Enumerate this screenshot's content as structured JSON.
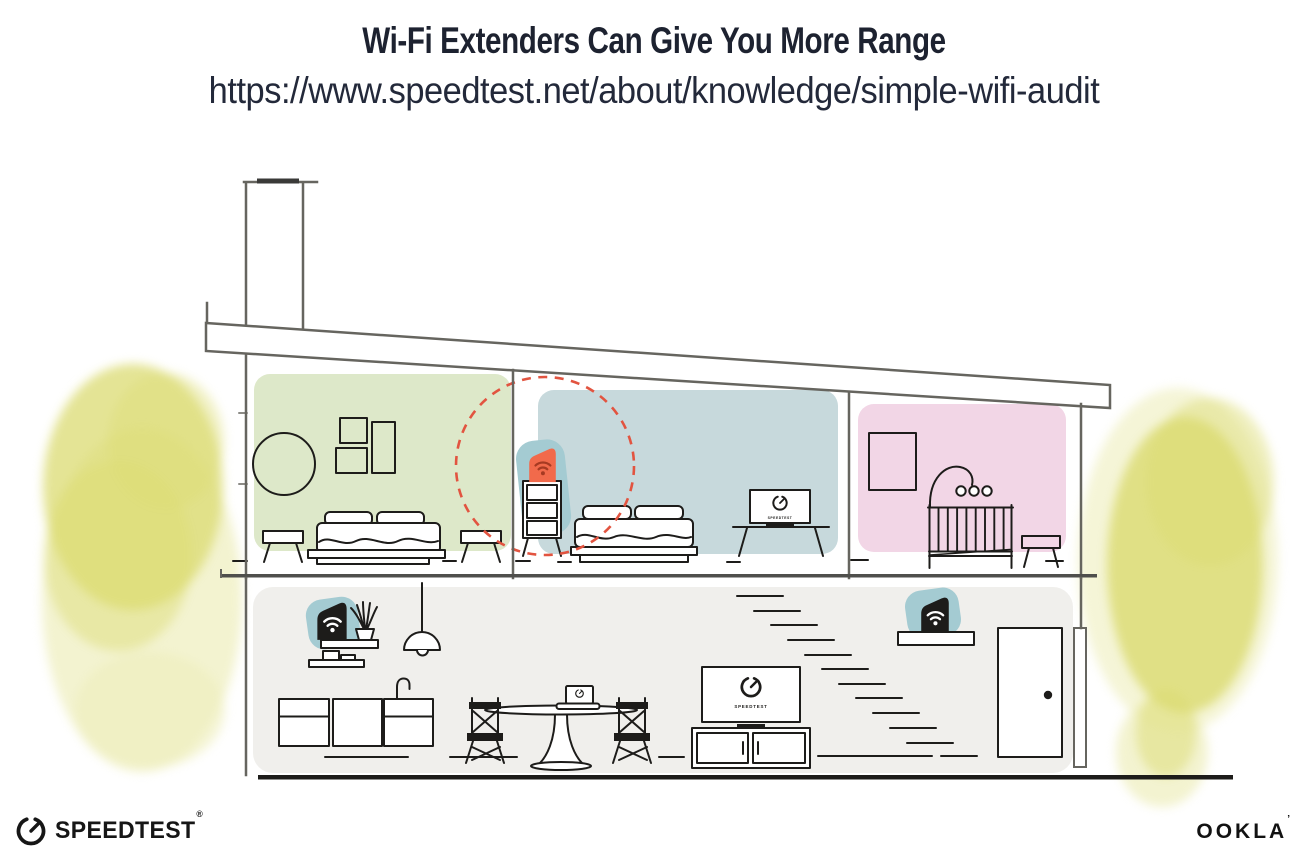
{
  "header": {
    "title": "Wi-Fi Extenders Can Give You More Range",
    "url": "https://www.speedtest.net/about/knowledge/simple-wifi-audit"
  },
  "house": {
    "tv_screen_label": "SPEEDTEST",
    "icons": {
      "upstairs_device": "wifi-extender-icon",
      "kitchen_device": "wifi-router-icon",
      "stairs_device": "wifi-extender-icon",
      "tv_logo": "speedtest-gauge-icon",
      "laptop_logo": "speedtest-gauge-icon",
      "range_marker": "dashed-range-circle"
    }
  },
  "footer": {
    "speedtest_wordmark": "SPEEDTEST",
    "speedtest_reg_mark": "®",
    "ookla_wordmark": "OOKLA",
    "ookla_reg_mark": "’"
  },
  "palette": {
    "titleColor": "#1d2230",
    "ink": "#1d1c1a",
    "structure": "#66655f",
    "greenRoom": "#dde8c9",
    "blueRoom": "#c7d9dc",
    "pinkRoom": "#f2d6e6",
    "grayFloor": "#f0efec",
    "teal": "#a4cbd2",
    "orange": "#f16a4b",
    "orangeWifi": "#a63a22",
    "redDash": "#e25440",
    "foliage": "#dbdb72",
    "foliageLight": "#eeeebc"
  }
}
